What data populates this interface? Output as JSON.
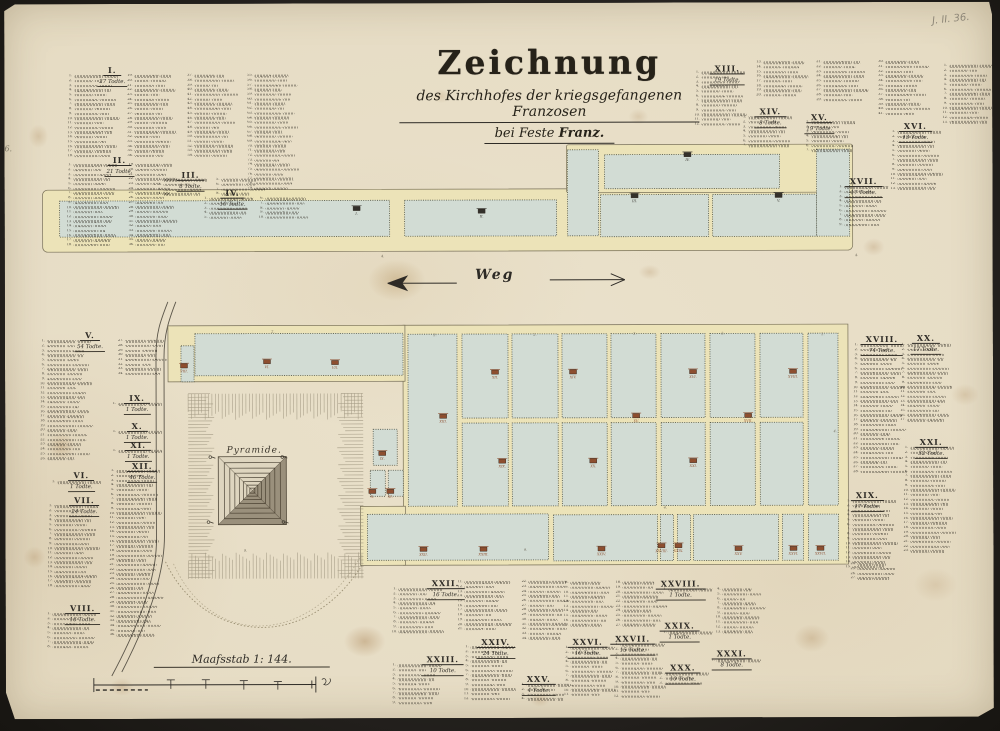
{
  "title": {
    "main": "Zeichnung",
    "line2": "des Kirchhofes der kriegsgefangenen Franzosen",
    "line3_prefix": "bei Feste ",
    "line3_bold": "Franz."
  },
  "annotations": {
    "pencil_note": "J. II. 36.",
    "margin_note": "6."
  },
  "colors": {
    "paper": "#e8dfc9",
    "path_yellow": "#ece3b8",
    "plot_green": "#d2dcd4",
    "ink": "#2e2b26",
    "marker_red": "#8d4e2f",
    "marker_dark": "#33302a"
  },
  "map": {
    "weg_label": "Weg",
    "pyramid_label": "Pyramide.",
    "scale_label": "Maafsstab 1: 144.",
    "bands": [
      [
        38,
        186,
        810,
        62,
        5
      ],
      [
        562,
        142,
        286,
        48,
        2
      ],
      [
        398,
        322,
        445,
        240,
        0
      ],
      [
        163,
        322,
        237,
        56,
        0
      ],
      [
        355,
        503,
        45,
        59,
        0
      ]
    ],
    "plots": [
      [
        55,
        197,
        330,
        36
      ],
      [
        400,
        197,
        152,
        36
      ],
      [
        563,
        147,
        31,
        86
      ],
      [
        600,
        152,
        175,
        34
      ],
      [
        596,
        192,
        108,
        42
      ],
      [
        708,
        192,
        104,
        42
      ],
      [
        812,
        147,
        33,
        87
      ],
      [
        190,
        330,
        208,
        42
      ],
      [
        176,
        342,
        13,
        36
      ],
      [
        403,
        331,
        49,
        172
      ],
      [
        803,
        331,
        30,
        172
      ],
      [
        457,
        331,
        46,
        84
      ],
      [
        507,
        331,
        46,
        84
      ],
      [
        557,
        331,
        45,
        84
      ],
      [
        606,
        331,
        45,
        84
      ],
      [
        656,
        331,
        44,
        84
      ],
      [
        705,
        331,
        45,
        84
      ],
      [
        755,
        331,
        43,
        84
      ],
      [
        457,
        420,
        46,
        83
      ],
      [
        507,
        420,
        46,
        83
      ],
      [
        557,
        420,
        45,
        83
      ],
      [
        606,
        420,
        45,
        83
      ],
      [
        656,
        420,
        44,
        83
      ],
      [
        705,
        420,
        45,
        83
      ],
      [
        755,
        420,
        43,
        83
      ],
      [
        368,
        426,
        24,
        36
      ],
      [
        365,
        467,
        15,
        26
      ],
      [
        383,
        467,
        15,
        26
      ],
      [
        362,
        511,
        181,
        46
      ],
      [
        548,
        512,
        104,
        46
      ],
      [
        655,
        512,
        13,
        46
      ],
      [
        672,
        512,
        13,
        46
      ],
      [
        688,
        512,
        85,
        46
      ],
      [
        777,
        512,
        21,
        46
      ],
      [
        803,
        512,
        30,
        46
      ]
    ],
    "markers": [
      [
        352,
        205,
        "I.",
        "dark"
      ],
      [
        477,
        208,
        "II.",
        "dark"
      ],
      [
        630,
        193,
        "III.",
        "dark"
      ],
      [
        683,
        152,
        "IV.",
        "dark"
      ],
      [
        774,
        193,
        "V.",
        "dark"
      ],
      [
        262,
        358,
        "VI.",
        "red"
      ],
      [
        330,
        359,
        "VII.",
        "red"
      ],
      [
        179,
        362,
        "VIII.",
        "red"
      ],
      [
        377,
        450,
        "IX.",
        "red"
      ],
      [
        367,
        488,
        "X.",
        "red"
      ],
      [
        385,
        488,
        "XI.",
        "red"
      ],
      [
        490,
        369,
        "XII.",
        "red"
      ],
      [
        568,
        369,
        "XIV.",
        "red"
      ],
      [
        688,
        369,
        "XVI.",
        "red"
      ],
      [
        788,
        369,
        "XVIII.",
        "red"
      ],
      [
        438,
        413,
        "XIII.",
        "red"
      ],
      [
        631,
        413,
        "XV.",
        "red"
      ],
      [
        743,
        413,
        "XVII.",
        "red"
      ],
      [
        497,
        458,
        "XIX.",
        "red"
      ],
      [
        588,
        458,
        "XX.",
        "red"
      ],
      [
        688,
        458,
        "XXI.",
        "red"
      ],
      [
        418,
        546,
        "XXII.",
        "red"
      ],
      [
        478,
        546,
        "XXIII.",
        "red"
      ],
      [
        596,
        546,
        "XXIV.",
        "red"
      ],
      [
        656,
        543,
        "XXVIII.",
        "red"
      ],
      [
        673,
        543,
        "XXIX.",
        "red"
      ],
      [
        733,
        546,
        "XXV.",
        "red"
      ],
      [
        788,
        546,
        "XXVI.",
        "red"
      ],
      [
        815,
        546,
        "XXVII.",
        "red"
      ]
    ],
    "ticks": [
      [
        378,
        254,
        "4."
      ],
      [
        852,
        254,
        "4."
      ],
      [
        268,
        329,
        "2."
      ],
      [
        430,
        333,
        "2."
      ],
      [
        530,
        333,
        "2."
      ],
      [
        630,
        332,
        "2."
      ],
      [
        718,
        332,
        "2."
      ],
      [
        818,
        333,
        "2."
      ],
      [
        240,
        548,
        "9."
      ],
      [
        520,
        548,
        "9."
      ],
      [
        660,
        506,
        "4."
      ],
      [
        830,
        430,
        "4."
      ]
    ]
  },
  "lists": [
    {
      "numeral": "I.",
      "subtitle": "27 Todte.",
      "h": [
        108,
        56
      ],
      "cols": [
        [
          63,
          70,
          18
        ],
        [
          123,
          70,
          18
        ],
        [
          183,
          70,
          18
        ],
        [
          243,
          70,
          25
        ]
      ]
    },
    {
      "numeral": "II.",
      "subtitle": "21 Todte.",
      "h": [
        115,
        146
      ],
      "cols": [
        [
          62,
          159,
          18
        ],
        [
          124,
          159,
          18
        ]
      ]
    },
    {
      "numeral": "III.",
      "subtitle": "8 Todte.",
      "h": [
        186,
        161
      ],
      "cols": [
        [
          152,
          174,
          4
        ],
        [
          210,
          174,
          4
        ]
      ]
    },
    {
      "numeral": "IV.",
      "subtitle": "10 Todte.",
      "h": [
        228,
        179
      ],
      "cols": [
        [
          198,
          193,
          5
        ],
        [
          254,
          193,
          5
        ]
      ]
    },
    {
      "numeral": "XIII.",
      "subtitle": "19 Todte.",
      "h": [
        723,
        56
      ],
      "cols": [
        [
          690,
          68,
          12
        ],
        [
          752,
          58,
          8
        ],
        [
          812,
          58,
          9
        ],
        [
          874,
          58,
          12
        ]
      ]
    },
    {
      "numeral": "XIV.",
      "subtitle": "8 Todte.",
      "h": [
        766,
        99
      ],
      "cols": [
        [
          737,
          113,
          7
        ]
      ]
    },
    {
      "numeral": "XV.",
      "subtitle": "19 Todte.",
      "h": [
        815,
        105
      ],
      "cols": [
        [
          800,
          118,
          7
        ]
      ]
    },
    {
      "numeral": "XVI.",
      "subtitle": "13 Todte.",
      "h": [
        911,
        114
      ],
      "cols": [
        [
          886,
          128,
          13
        ]
      ]
    },
    {
      "numeral": "XVII.",
      "subtitle": "17 Todte.",
      "h": [
        859,
        169
      ],
      "cols": [
        [
          833,
          183,
          9
        ]
      ]
    },
    {
      "numeral": null,
      "subtitle": null,
      "h": null,
      "cols": [
        [
          938,
          62,
          13
        ]
      ]
    },
    {
      "numeral": "V.",
      "subtitle": "54 Todte.",
      "h": [
        85,
        321
      ],
      "cols": [
        [
          35,
          335,
          26
        ],
        [
          113,
          335,
          8
        ]
      ]
    },
    {
      "numeral": "IX.",
      "subtitle": "1 Todte.",
      "h": [
        132,
        384
      ],
      "cols": [
        [
          106,
          398,
          1
        ]
      ]
    },
    {
      "numeral": "X.",
      "subtitle": "1 Todte.",
      "h": [
        132,
        412
      ],
      "cols": [
        [
          106,
          426,
          1
        ]
      ]
    },
    {
      "numeral": "XI.",
      "subtitle": "1 Todte.",
      "h": [
        133,
        431
      ],
      "cols": [
        [
          106,
          445,
          1
        ]
      ]
    },
    {
      "numeral": "XII.",
      "subtitle": "46 Todte.",
      "h": [
        137,
        452
      ],
      "cols": [
        [
          104,
          465,
          36
        ]
      ]
    },
    {
      "numeral": "VI.",
      "subtitle": "1 Todte.",
      "h": [
        76,
        461
      ],
      "cols": [
        [
          45,
          476,
          1
        ]
      ]
    },
    {
      "numeral": "VII.",
      "subtitle": "24 Todte.",
      "h": [
        79,
        486
      ],
      "cols": [
        [
          42,
          500,
          18
        ]
      ]
    },
    {
      "numeral": "VIII.",
      "subtitle": "16 Todte.",
      "h": [
        77,
        594
      ],
      "cols": [
        [
          40,
          608,
          8
        ]
      ]
    },
    {
      "numeral": "XVIII.",
      "subtitle": "74 Todte.",
      "h": [
        877,
        327
      ],
      "cols": [
        [
          848,
          341,
          28
        ]
      ]
    },
    {
      "numeral": "XIX.",
      "subtitle": "17 Todte.",
      "h": [
        862,
        483
      ],
      "cols": [
        [
          840,
          497,
          15
        ]
      ]
    },
    {
      "numeral": "XX.",
      "subtitle": "17 Todte.",
      "h": [
        921,
        326
      ],
      "cols": [
        [
          895,
          341,
          17
        ]
      ]
    },
    {
      "numeral": "XXI.",
      "subtitle": "32 Todte.",
      "h": [
        926,
        430
      ],
      "cols": [
        [
          898,
          444,
          23
        ],
        [
          845,
          560,
          4
        ]
      ]
    },
    {
      "numeral": "XXII.",
      "subtitle": "16 Todte.",
      "h": [
        440,
        570
      ],
      "cols": [
        [
          386,
          584,
          10
        ],
        [
          452,
          577,
          11
        ],
        [
          516,
          577,
          13
        ]
      ]
    },
    {
      "numeral": "XXIII.",
      "subtitle": "10 Todte.",
      "h": [
        437,
        646
      ],
      "cols": [
        [
          385,
          660,
          9
        ]
      ]
    },
    {
      "numeral": "XXIV.",
      "subtitle": "24 Todte.",
      "h": [
        490,
        629
      ],
      "cols": [
        [
          458,
          642,
          12
        ]
      ]
    },
    {
      "numeral": "XXV.",
      "subtitle": "4 Todte.",
      "h": [
        533,
        666
      ],
      "cols": [
        [
          514,
          680,
          4
        ]
      ]
    },
    {
      "numeral": null,
      "subtitle": null,
      "h": null,
      "start": 8,
      "cols": [
        [
          558,
          578,
          10
        ],
        [
          610,
          578,
          10
        ]
      ]
    },
    {
      "numeral": "XXVI.",
      "subtitle": "10 Todte.",
      "h": [
        582,
        629
      ],
      "cols": [
        [
          558,
          643,
          11
        ]
      ]
    },
    {
      "numeral": "XXVII.",
      "subtitle": "15 Todte.",
      "h": [
        627,
        626
      ],
      "cols": [
        [
          608,
          640,
          12
        ]
      ]
    },
    {
      "numeral": "XXVIII.",
      "subtitle": "1 Todte.",
      "h": [
        675,
        571
      ],
      "cols": [
        [
          656,
          585,
          1
        ]
      ]
    },
    {
      "numeral": null,
      "subtitle": null,
      "h": null,
      "start": 4,
      "cols": [
        [
          710,
          585,
          10
        ]
      ]
    },
    {
      "numeral": "XXIX.",
      "subtitle": "1 Todte.",
      "h": [
        674,
        613
      ],
      "cols": [
        [
          656,
          628,
          1
        ]
      ]
    },
    {
      "numeral": "XXX.",
      "subtitle": "10 Todte.",
      "h": [
        677,
        655
      ],
      "cols": [
        [
          652,
          669,
          3
        ]
      ]
    },
    {
      "numeral": "XXXI.",
      "subtitle": "8 Todte.",
      "h": [
        726,
        641
      ],
      "cols": [
        [
          704,
          656,
          1
        ]
      ]
    }
  ]
}
